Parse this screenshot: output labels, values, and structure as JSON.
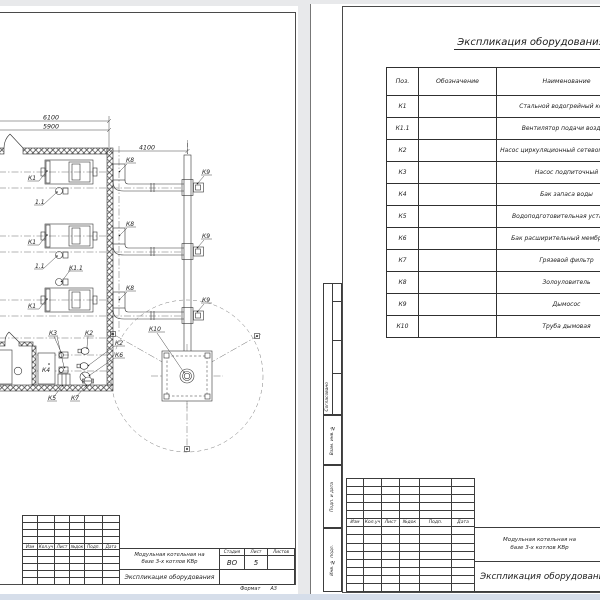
{
  "left_sheet": {
    "dims": {
      "top_outer": "6100",
      "top_inner": "5900",
      "duct": "4100"
    },
    "tags": {
      "k1": "К1",
      "k1_1": "К1.1",
      "k1_1_short": "1.1",
      "k2": "К2",
      "k3": "К3",
      "k4": "К4",
      "k5": "К5",
      "k6": "К6",
      "k7": "К7",
      "k8": "К8",
      "k9": "К9",
      "k10": "К10"
    },
    "title_block": {
      "revision_headers": [
        "Изм",
        "Кол.уч",
        "Лист",
        "№док",
        "Подп.",
        "Дата"
      ],
      "project_line1": "Модульная котельная на",
      "project_line2": "базе 3-х котлов КВр",
      "doc_title": "Экспликация оборудования",
      "stage_label": "Стадия",
      "sheet_label": "Лист",
      "sheets_label": "Листов",
      "stage": "ВО",
      "sheet_no": "5",
      "format_label": "Формат",
      "format_value": "А3"
    }
  },
  "right_sheet": {
    "spec_title": "Экспликация оборудования",
    "table": {
      "col_pos": "Поз.",
      "col_designation": "Обозначение",
      "col_name": "Наименование",
      "rows": [
        {
          "pos": "К1",
          "name": "Стальной водогрейный котел"
        },
        {
          "pos": "К1.1",
          "name": "Вентилятор подачи воздуха"
        },
        {
          "pos": "К2",
          "name": "Насос циркуляционный сетевого контура"
        },
        {
          "pos": "К3",
          "name": "Насос подпиточный"
        },
        {
          "pos": "К4",
          "name": "Бак запаса воды"
        },
        {
          "pos": "К5",
          "name": "Водоподготовительная установка"
        },
        {
          "pos": "К6",
          "name": "Бак расширительный мембранный"
        },
        {
          "pos": "К7",
          "name": "Грязевой фильтр"
        },
        {
          "pos": "К8",
          "name": "Золоуловитель"
        },
        {
          "pos": "К9",
          "name": "Дымосос"
        },
        {
          "pos": "К10",
          "name": "Труба дымовая"
        }
      ]
    },
    "side_stamps": {
      "approved": "Согласовано",
      "replace_inv": "Взам. инв. №",
      "sign_date": "Подп. и дата",
      "inv_orig": "Инв. № подл."
    },
    "title_block": {
      "revision_headers": [
        "Изм",
        "Кол.уч",
        "Лист",
        "№док",
        "Подп.",
        "Дата"
      ],
      "project_line1": "Модульная котельная на",
      "project_line2": "базе 3-х котлов КВр",
      "doc_title": "Экспликация оборудования"
    }
  }
}
